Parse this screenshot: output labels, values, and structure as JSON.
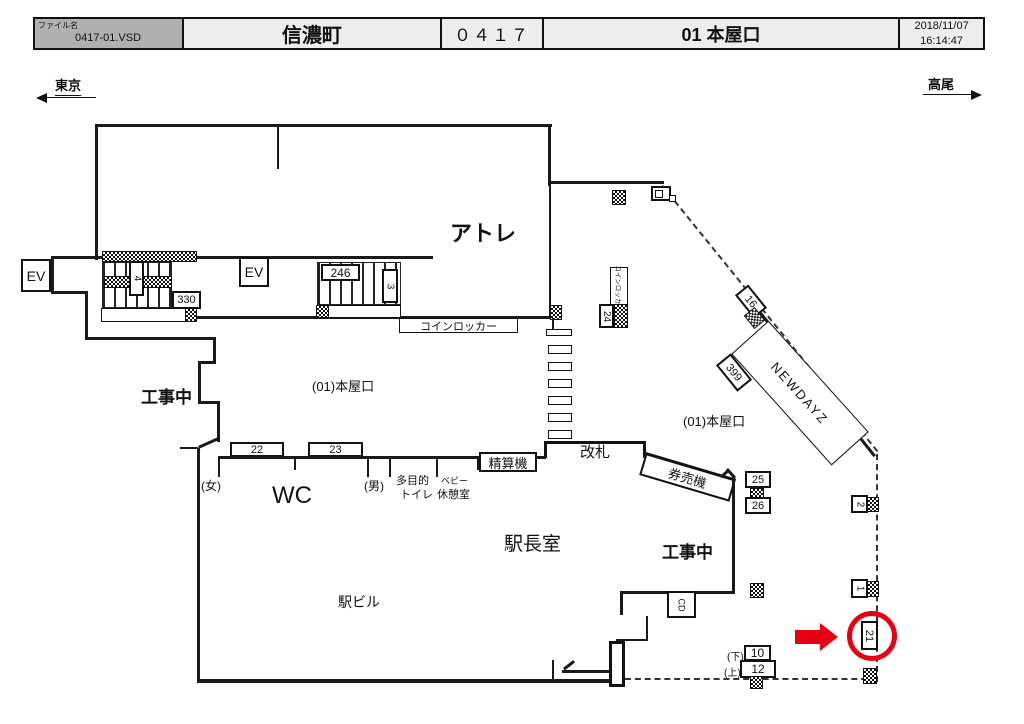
{
  "header": {
    "file_label": "ファイル名",
    "file_name": "0417-01.VSD",
    "station_name": "信濃町",
    "station_code": "０４１７",
    "gate_name": "01 本屋口",
    "date": "2018/11/07",
    "time": "16:14:47"
  },
  "directions": {
    "left": "東京",
    "right": "高尾"
  },
  "plan": {
    "atre": "アトレ",
    "ev": "EV",
    "stair_4": "4",
    "stair_3": "3",
    "sign_330": "330",
    "sign_246": "246",
    "coin_locker": "コインロッカー",
    "coin_locker_small": "コインロッカー",
    "sign_24": "24",
    "sign_16": "16",
    "sign_399": "399",
    "newdays": "NEWDAYZ",
    "gate_name_left": "(01)本屋口",
    "gate_name_right": "(01)本屋口",
    "construction": "工事中",
    "wc": "WC",
    "women": "(女)",
    "men": "(男)",
    "multipurpose_1": "多目的",
    "multipurpose_2": "トイレ",
    "baby_1": "ベビー",
    "baby_2": "休憩室",
    "fare_machine": "精算機",
    "ticket_gate": "改札",
    "ticket_machine": "券売機",
    "master_room": "駅長室",
    "station_bldg": "駅ビル",
    "cd": "CD",
    "sign_22": "22",
    "sign_23": "23",
    "sign_25": "25",
    "sign_26": "26",
    "sign_2": "2",
    "sign_1": "1",
    "sign_21": "21",
    "sign_10": "10",
    "sign_12": "12",
    "down": "(下)",
    "up": "(上)"
  },
  "colors": {
    "highlight": "#e60012"
  }
}
